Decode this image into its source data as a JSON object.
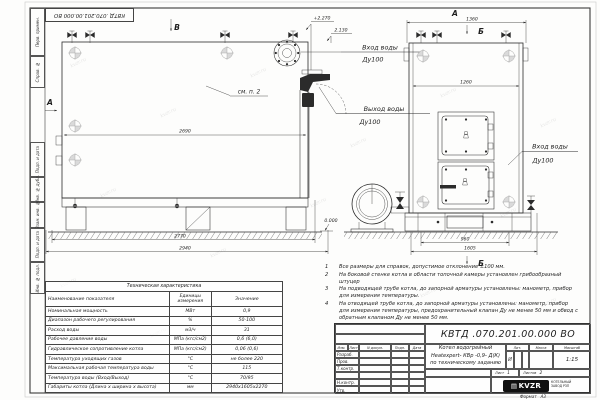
{
  "colors": {
    "line": "#2b2b2b",
    "paper": "#fdfdfc",
    "gray_mark": "#a0a0a0"
  },
  "watermark": "kvzr.ru",
  "stamp_top": "КВТД .070.201.00.000  ВО",
  "frame_fields": {
    "perv_primen": "Перв. примен.",
    "sprav_no": "Справ. №",
    "podp_data1": "Подп. и дата",
    "inv_dubl": "Инв. № дубл.",
    "vzam_inv": "Взам. инв. №",
    "podp_data2": "Подп. и дата",
    "inv_podl": "Инв. № подл."
  },
  "views": {
    "view_b_label": "В",
    "view_a_label": "А",
    "view_a_top_label": "А",
    "section_b_top": "Б",
    "section_b_bottom": "Б",
    "see_note": "см. п. 2",
    "inlet_label_line1": "Вход воды",
    "inlet_label_line2": "Ду100",
    "outlet_label_line1": "Выход воды",
    "outlet_label_line2": "Ду100",
    "inlet_right_line1": "Вход воды",
    "inlet_right_line2": "Ду100",
    "elev_top": "+2.270",
    "elev_mid": "2.130",
    "elev_zero": "0.000",
    "dims": {
      "d2690": "2690",
      "d2770": "2770",
      "d2940": "2940",
      "d1360": "1360",
      "d1260": "1260",
      "d960": "960",
      "d1605": "1605"
    }
  },
  "notes": {
    "items": [
      {
        "num": "1",
        "text": "Все размеры для справок, допустимое отклонение ±100 мм."
      },
      {
        "num": "2",
        "text": "На боковой стенке котла в области топочной камеры установлен грибообразный штуцер"
      },
      {
        "num": "3",
        "text": "На подводящей трубе котла, до запорной арматуры установлены: манометр, прибор для измерения температуры."
      },
      {
        "num": "4",
        "text": "На отводящей трубе котла, до запорной арматуры установлены: манометр, прибор для измерения температуры, предохранительный клапан Ду не менее 50 мм и обвод с обратным клапаном Ду не менее 50 мм."
      }
    ]
  },
  "spec_table": {
    "title": "Техническая характеристика",
    "col_name": "Наименование показателя",
    "col_units": "Единицы измерения",
    "col_value": "Значение",
    "rows": [
      {
        "name": "Номинальная мощность",
        "units": "МВт",
        "value": "0,9"
      },
      {
        "name": "Диапазон рабочего регулирования",
        "units": "%",
        "value": "50-100"
      },
      {
        "name": "Расход воды",
        "units": "м3/ч",
        "value": "31"
      },
      {
        "name": "Рабочее давление воды",
        "units": "МПа (кгс/см2)",
        "value": "0,6 (6,0)"
      },
      {
        "name": "Гидравлическое сопротивление котла",
        "units": "МПа (кгс/см2)",
        "value": "0,06 (0,6)"
      },
      {
        "name": "Температура уходящих газов",
        "units": "°С",
        "value": "не более 220"
      },
      {
        "name": "Максимальная рабочая температура воды",
        "units": "°С",
        "value": "115"
      },
      {
        "name": "Температура воды (Вход/Выход)",
        "units": "°С",
        "value": "70/95"
      },
      {
        "name": "Габариты котла (Длина х ширина х высота)",
        "units": "мм",
        "value": "2940х1605х2270"
      }
    ]
  },
  "title_block": {
    "doc_number": "КВТД .070.201.00.000  ВО",
    "name_line1": "Котел водогрейный",
    "name_line2": "Heatexpert- КВр -0,9- Д(К)",
    "name_line3": "по техническому заданию",
    "col_izm": "Изм.",
    "col_list": "Лист",
    "col_doc": "N докум.",
    "col_podp": "Подп.",
    "col_data": "Дата",
    "row_razrab": "Разраб.",
    "row_prov": "Пров.",
    "row_tkontr": "Т.контр.",
    "row_nkontr": "Н.контр.",
    "row_utv": "Утв.",
    "lit_header": "Лит.",
    "massa_header": "Масса",
    "masshtab_header": "Масштаб",
    "lit_value": "И",
    "scale_value": "1:15",
    "sheet_label": "Лист",
    "sheet_value": "1",
    "sheets_label": "Листов",
    "sheets_value": "2",
    "logo_text": "KVZR",
    "logo_caption_line1": "КОТЕЛЬНЫЙ",
    "logo_caption_line2": "ЗАВОД РЗП",
    "format_label": "Формат",
    "format_value": "А3"
  }
}
